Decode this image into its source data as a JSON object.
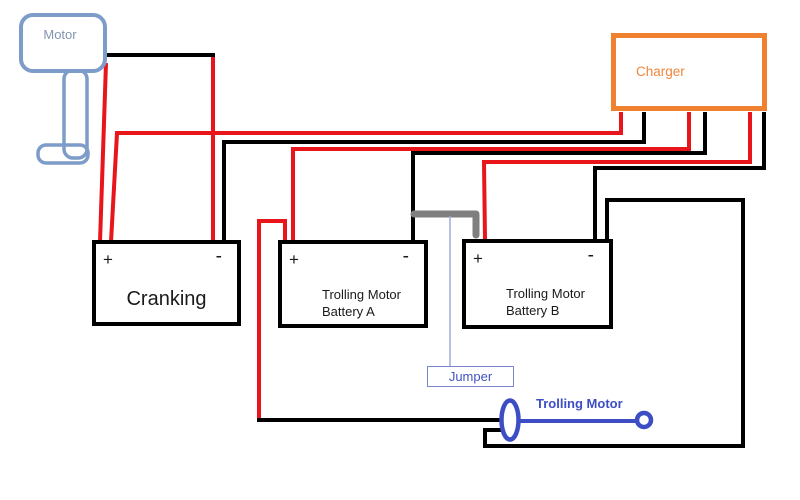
{
  "motor": {
    "label": "Motor"
  },
  "charger": {
    "label": "Charger"
  },
  "cranking": {
    "plus": "+",
    "minus": "-",
    "label": "Cranking"
  },
  "battery_a": {
    "plus": "+",
    "minus": "-",
    "label": "Trolling Motor\nBattery A"
  },
  "battery_b": {
    "plus": "+",
    "minus": "-",
    "label": "Trolling Motor\nBattery B"
  },
  "jumper": {
    "label": "Jumper"
  },
  "trolling_motor": {
    "label": "Trolling Motor"
  },
  "colors": {
    "positive_wire": "#e8151b",
    "negative_wire": "#000000",
    "jumper_wire": "#7f7f7f",
    "motor_outline": "#7e9cc9",
    "motor_text": "#8494b0",
    "charger_outline": "#f08130",
    "charger_text": "#f0863c",
    "battery_outline": "#000000",
    "blue_accent": "#3d4ec4",
    "jumper_label_border": "#7c86ce",
    "jumper_label_text": "#4353c4",
    "connector_line": "#a3abdc"
  }
}
